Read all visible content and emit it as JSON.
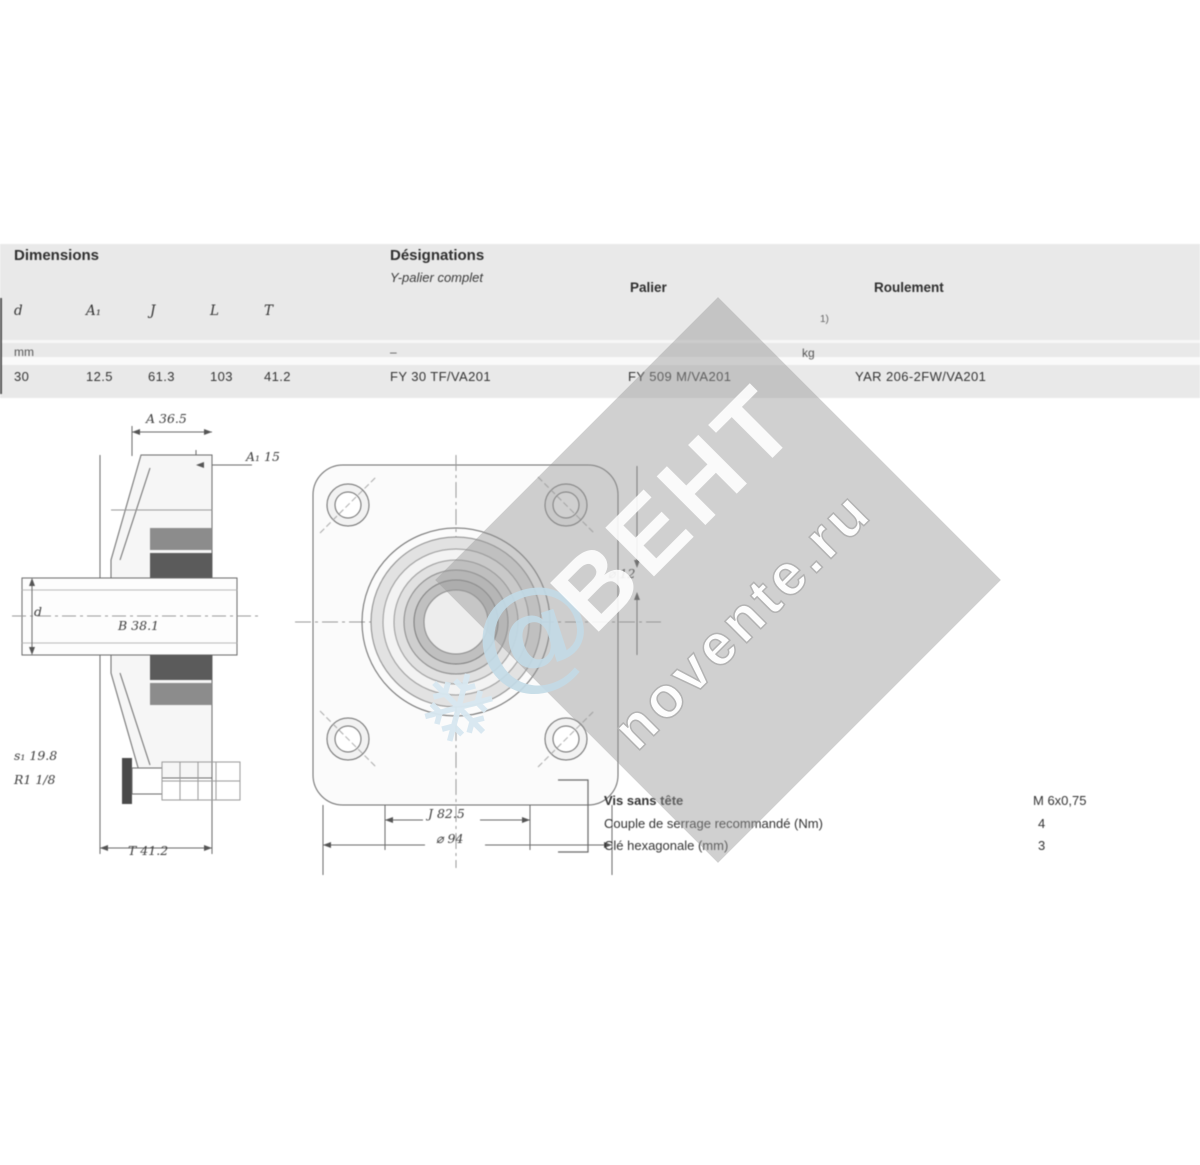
{
  "table": {
    "dimensions_title": "Dimensions",
    "designations_title": "Désignations",
    "designations_subtitle": "Y-palier complet",
    "palier_header": "Palier",
    "roulement_header": "Roulement",
    "footnote_marker": "1)",
    "symbols": {
      "d": "d",
      "a1": "A₁",
      "j": "J",
      "l": "L",
      "t": "T"
    },
    "units": {
      "mm": "mm",
      "dash": "–",
      "kg": "kg"
    },
    "row": {
      "d": "30",
      "a1": "12.5",
      "j": "61.3",
      "l": "103",
      "t": "41.2",
      "designation": "FY 30 TF/VA201",
      "palier": "FY 509 M/VA201",
      "roulement": "YAR 206-2FW/VA201"
    }
  },
  "side_view": {
    "dim_a": "A 36.5",
    "dim_a1": "A₁ 15",
    "dim_b": "B 38.1",
    "dim_d": "d",
    "dim_s1": "s₁ 19.8",
    "dim_r": "R1 1/8",
    "dim_t": "T 41.2"
  },
  "front_view": {
    "dim_n": "⌀ 12",
    "dim_j": "J 82.5",
    "dim_l": "⌀ 94"
  },
  "footer": {
    "rows": [
      {
        "label": "Vis sans tête",
        "value": "M 6x0,75"
      },
      {
        "label": "Couple de serrage recommandé (Nm)",
        "value": "4"
      },
      {
        "label": "Clé hexagonale (mm)",
        "value": "3"
      }
    ]
  },
  "watermark": {
    "brand": "ВЕНТ",
    "site": "novente.ru",
    "at_symbol": "@",
    "snowflake": "❄",
    "band_color": "#969696",
    "accent_color": "#c3dbe7"
  }
}
